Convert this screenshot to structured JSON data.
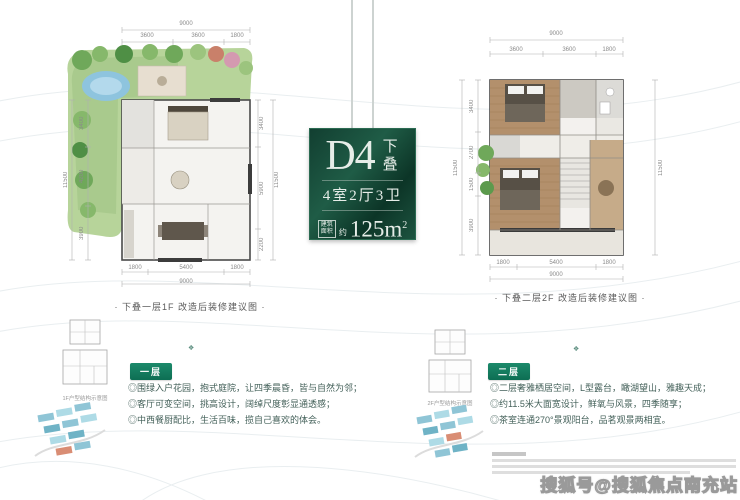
{
  "title_card": {
    "model": "D4",
    "stack_vertical": "下叠",
    "rooms": "4室2厅3卫",
    "area_box_line1": "建筑",
    "area_box_line2": "面积",
    "area_prefix": "约",
    "area_value": "125m",
    "area_exponent": "2"
  },
  "left_section": {
    "caption": "· 下叠一层1F 改造后装修建议图 ·",
    "ornament": "❖",
    "floor_tag": "一层",
    "bullets": [
      "◎围绿入户花园，抱式庭院，让四季晨昏，皆与自然为邻；",
      "◎客厅可变空间，挑高设计，阔绰尺度彰显通透感；",
      "◎中西餐厨配比，生活百味，揽自己喜欢的体会。"
    ],
    "schematic_label": "1F户型结构示意图",
    "dims": {
      "top_total": "9000",
      "top_segments": [
        "3600",
        "3600",
        "1800"
      ],
      "left_total": "11500",
      "left_segments": [
        "3400",
        "4200",
        "3900"
      ],
      "right_total": "11500",
      "right_segments": [
        "3400",
        "5900",
        "2200"
      ],
      "bottom_total": "9000",
      "bottom_segments": [
        "1800",
        "5400",
        "1800"
      ]
    }
  },
  "right_section": {
    "caption": "· 下叠二层2F 改造后装修建议图 ·",
    "ornament": "❖",
    "floor_tag": "二层",
    "bullets": [
      "◎二层奢雅栖居空间，L型露台，瞰湖望山，雅趣天成；",
      "◎约11.5米大面宽设计，鲜氧与风景，四季随享；",
      "◎茶室连通270°景观阳台，品茗观景两相宜。"
    ],
    "schematic_label": "2F户型结构示意图",
    "dims": {
      "top_total": "9000",
      "top_segments": [
        "3600",
        "3600",
        "1800"
      ],
      "left_total": "11500",
      "left_segments": [
        "3400",
        "2700",
        "1500",
        "3900"
      ],
      "right_total": "11500",
      "bottom_total": "9000",
      "bottom_segments": [
        "1800",
        "5400",
        "1800"
      ]
    }
  },
  "watermark": "搜狐号@搜狐焦点南充站",
  "colors": {
    "accent_green": "#157a5f",
    "card_green_dark": "#0c3527",
    "card_green_light": "#1f5c46",
    "garden_green": "#b7d49a",
    "pond_blue": "#8ec4de",
    "wood_floor": "#b3906c",
    "site_thumb_teal": "#8fc5d6"
  }
}
